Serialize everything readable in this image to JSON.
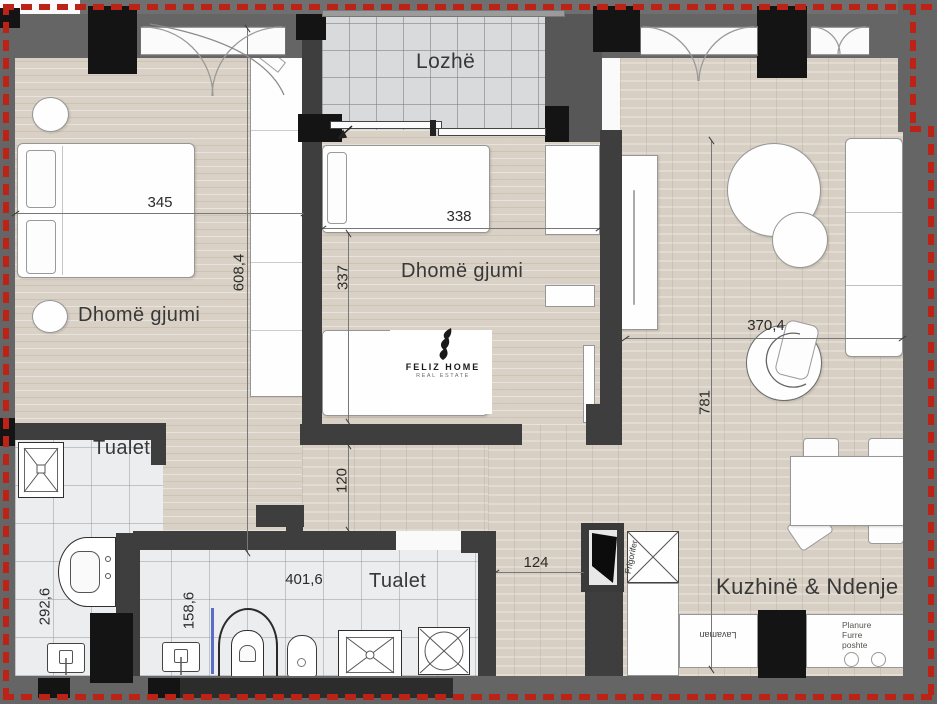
{
  "title": "Apartment floor plan",
  "rooms": {
    "loggia": "Lozhë",
    "bedroom1": "Dhomë gjumi",
    "bedroom2": "Dhomë gjumi",
    "bathroom1": "Tualet",
    "bathroom2": "Tualet",
    "kitchen_living": "Kuzhinë & Ndenje"
  },
  "dimensions": {
    "room1_width": "345",
    "room1_height": "608,4",
    "bed2_width": "338",
    "room2_height": "337",
    "corridor_width": "120",
    "entrance_width": "124",
    "bath2_width": "401,6",
    "bath2_height": "158,6",
    "bath1_height": "292,6",
    "living_width": "370,4",
    "living_height": "781"
  },
  "kitchen": {
    "sink_label": "Lavaman",
    "fridge_label": "Frigorifer",
    "stove_label": "Planure Furre poshte"
  },
  "logo": {
    "name": "FELIZ HOME",
    "tagline": "REAL ESTATE"
  },
  "colors": {
    "boundary_red": "#bd2217",
    "wall_dark": "#3e3e3e",
    "wall_gray": "#656565",
    "column_black": "#141414",
    "wood_floor": "#d9d1c5",
    "tile_gray": "#d8dadb",
    "tile_white": "#ebedee"
  }
}
